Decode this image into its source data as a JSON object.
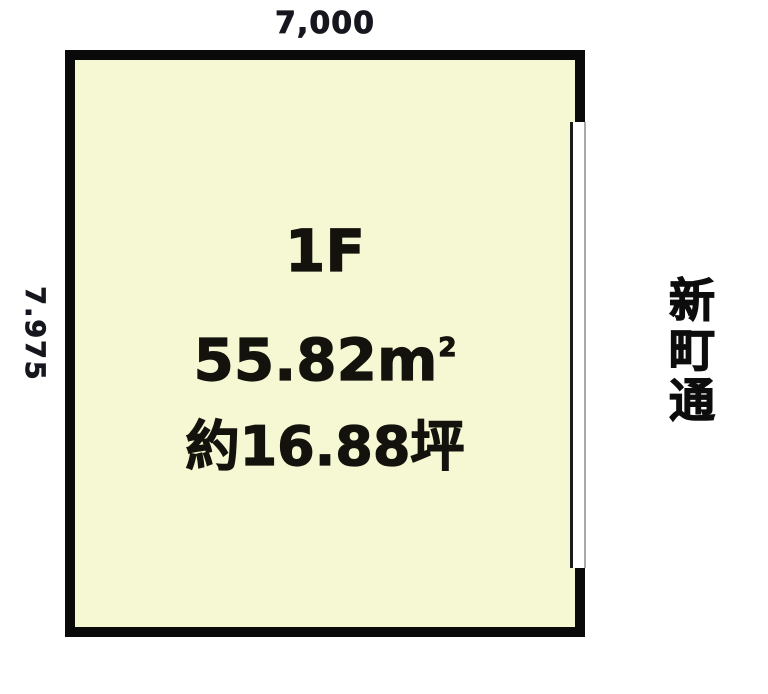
{
  "floorplan": {
    "dimension_top": "7,000",
    "dimension_left": "7.975",
    "room": {
      "floor_label": "1F",
      "area_number": "55.82",
      "area_unit_base": "m",
      "area_unit_exp": "2",
      "area_tsubo": "約16.88坪"
    },
    "street_name": "新町通",
    "colors": {
      "background": "#ffffff",
      "wall": "#0a0a0a",
      "room_fill": "#f6f8d3",
      "dimension_text": "#16161e",
      "room_text": "#14120c",
      "street_text": "#0d0d0d",
      "opening_inner_line": "#1c1c1c",
      "opening_outer_line": "#a9a9a9"
    }
  }
}
